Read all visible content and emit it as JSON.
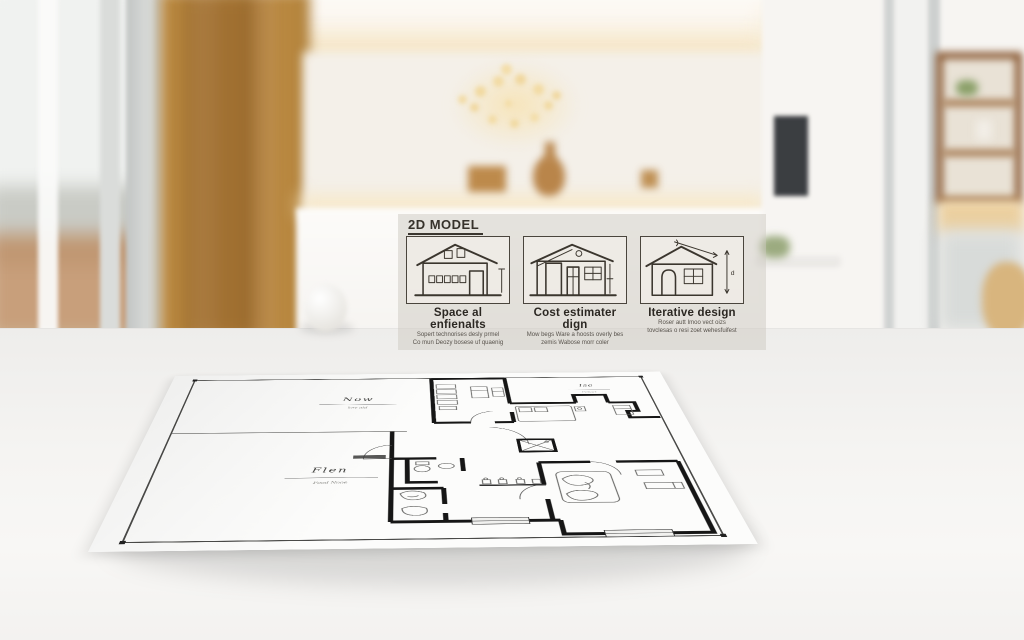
{
  "overlay": {
    "title": "2D MODEL",
    "panels": [
      {
        "icon": "two-story-house-sketch-icon",
        "caption": "Space al enfienalts",
        "sub1": "Sopert technorises desly prmel",
        "sub2": "Co mun Deozy bosese uf quaenig"
      },
      {
        "icon": "single-story-house-sketch-icon",
        "caption": "Cost estimater dign",
        "sub1": "Mow begs Ware a hoosts overly bes",
        "sub2": "zemis Wabose morr coler"
      },
      {
        "icon": "dimensioned-house-sketch-icon",
        "caption": "Iterative design",
        "sub1": "Roser autt Imoo vect oizs",
        "sub2": "tovclesas o resi zoet wehesfuifest"
      }
    ]
  },
  "floor_plan": {
    "labels": {
      "room_top_left": {
        "name": "Now",
        "sub": "kev aid"
      },
      "room_left": {
        "name": "Flen",
        "sub": "Food Nooe"
      },
      "room_top_right": {
        "name": "Ise",
        "sub": "Ismarl"
      }
    },
    "dimension_label": "d"
  },
  "colors": {
    "wood_wall": "#b8873f",
    "warm_light": "#f5e2ba",
    "paper": "#fcfcfb",
    "plan_wall": "#161616",
    "overlay_band": "rgba(206,201,193,0.5)",
    "tv_screen": "#3b3e41",
    "table_surface": "#f5f4f2"
  }
}
